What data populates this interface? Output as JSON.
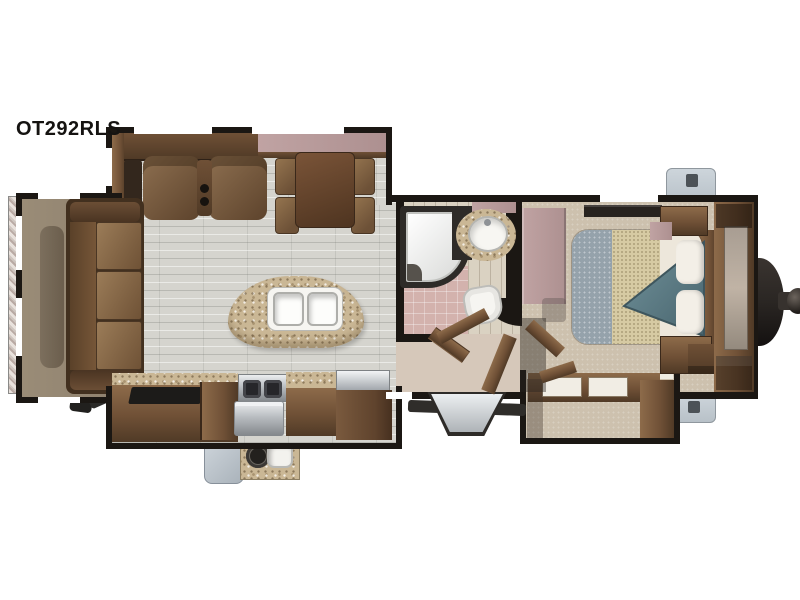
{
  "title": {
    "model_label": "OT292RLS"
  },
  "floorplan": {
    "kind": "travel trailer floor plan, overhead 3D render",
    "orientation": {
      "front_hitch": "right",
      "rear": "left",
      "entry_door": "bottom center-right"
    },
    "slide_outs": [
      "rear sofa slide (left end)",
      "road-side living slide with theater seating and dinette (top)",
      "door-side kitchen slide with outside kitchen (bottom)",
      "bedroom wardrobe slide (bottom right)"
    ],
    "living_area_items": [
      "tri-fold sofa",
      "theater seats with center cupholders",
      "side table",
      "overhead cabinets",
      "free-standing dinette table with four chairs",
      "kitchen island with double sink",
      "entertainment center with TV"
    ],
    "kitchen_items": [
      "three-burner range with oven",
      "granite countertop",
      "refrigerator",
      "outside kitchen with burner and sink",
      "entry door",
      "fold-out entry steps"
    ],
    "bathroom_items": [
      "corner shower",
      "round vanity sink",
      "toilet"
    ],
    "bedroom_items": [
      "queen bed with turned-down blanket",
      "two pillows with headboard",
      "nightstands",
      "mirrored wardrobe",
      "front wardrobe closet",
      "wardrobe slide dresser"
    ],
    "exterior_items": [
      "A-frame hitch with coupler",
      "two utility boxes",
      "rear accessory rack",
      "stabilizer jacks"
    ]
  },
  "colors": {
    "wall": "#1b1713",
    "tile": "#d5d4ce",
    "carpet": "#cdc1ae",
    "lino": "#d6c8ba",
    "bathwood": "#dad2c2",
    "pink": "#d3b2ad",
    "mauve": "#c0a3a3",
    "granite": "#cab795",
    "woodDark": "#503a26",
    "wood": "#6f5036",
    "woodLight": "#8d6b4a",
    "cushion": "#94744f",
    "slideFloor": "#8f816e",
    "steel": "#b9bdc1",
    "fridgeWood": "#5f432d",
    "teal": "#5f7f88",
    "tealDark": "#47636c",
    "quilt": "#95a2ab",
    "weave": "#d6caa3",
    "sheet": "#ede7db",
    "grayBox": "#b8c1c8",
    "stepGray": "#d4d7da",
    "hitch": "#2a2623"
  }
}
